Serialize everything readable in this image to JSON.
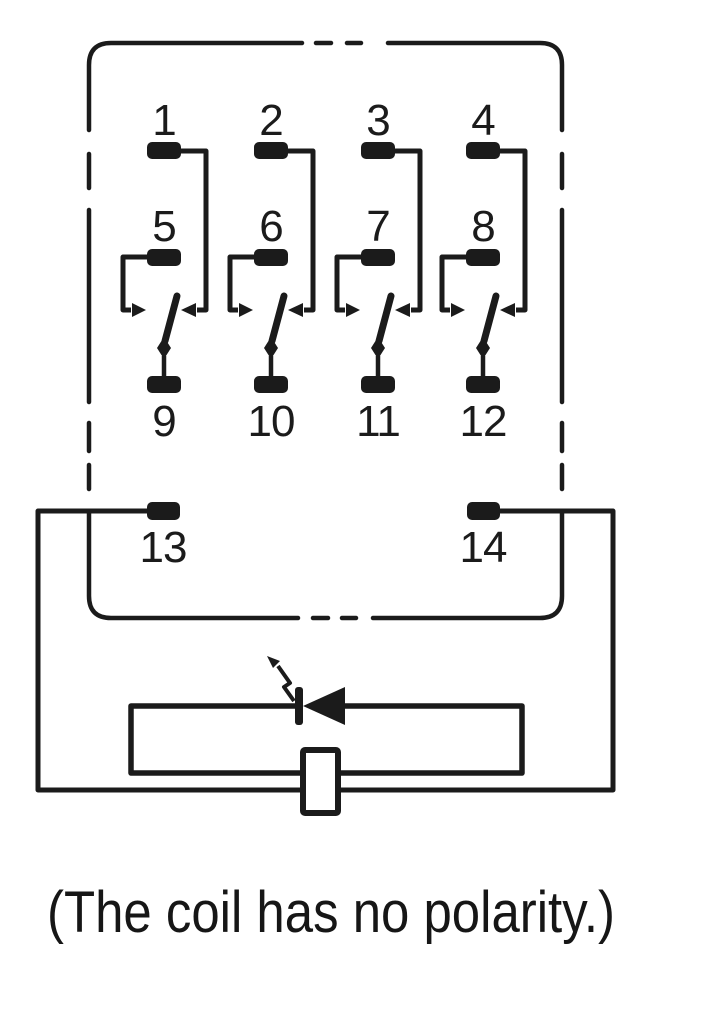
{
  "figure": {
    "type": "relay-wiring-schematic",
    "caption": "(The coil has no polarity.)",
    "pins": {
      "nc": [
        "1",
        "2",
        "3",
        "4"
      ],
      "no": [
        "5",
        "6",
        "7",
        "8"
      ],
      "com": [
        "9",
        "10",
        "11",
        "12"
      ],
      "coil": [
        "13",
        "14"
      ]
    },
    "symbols": [
      "relay-body-dashed-outline",
      "changeover-contact-x4",
      "led-indicator-diode",
      "coil-box"
    ],
    "colors": {
      "ink": "#1b1b1b",
      "background": "#ffffff"
    }
  }
}
